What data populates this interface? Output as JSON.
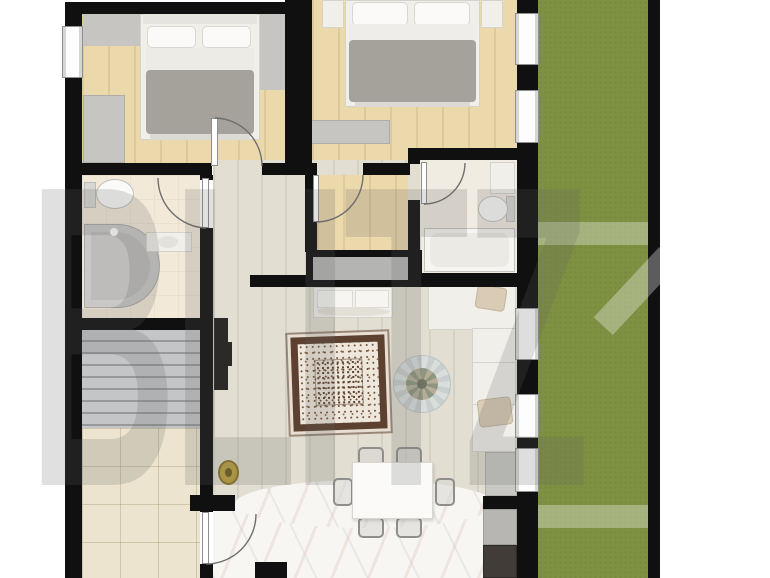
{
  "watermark": {
    "text": "BLITZ"
  },
  "plan": {
    "type": "apartment-floor-plan",
    "palette": {
      "wall": "#101010",
      "garden_grass": "#7e9041",
      "bedroom_wood": "#ecd9ab",
      "living_wood": "#e2ded1",
      "bathroom_floor": "#f3e9d9",
      "porch_tiles": "#ece4cf",
      "kitchen_marble": "#f8f6f3",
      "stairs_gray": "#c4c5c7",
      "rug_border_brown": "#5c4030",
      "gold_decor": "#b99f3f",
      "tv_black": "#2b2a28",
      "watermark_gray": "rgba(102,102,102,0.20)"
    }
  }
}
